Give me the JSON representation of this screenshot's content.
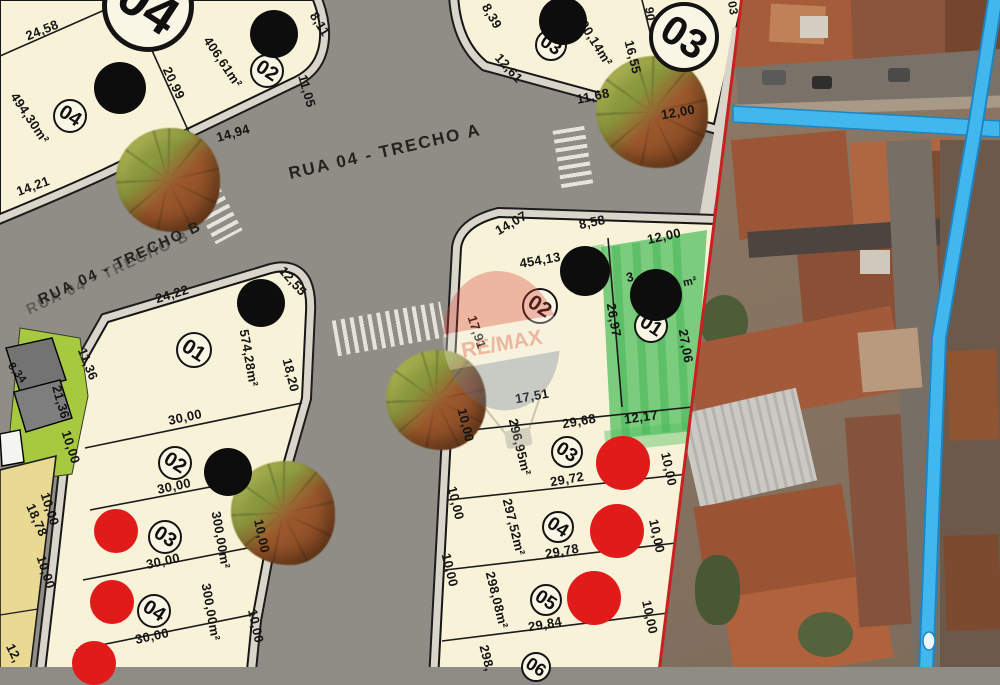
{
  "colors": {
    "lot_fill": "#f8f2d8",
    "street": "#8f8c86",
    "sidewalk": "#d9d5ca",
    "boundary_red": "#c92020",
    "highlight_green": "#57c163",
    "sold_dot_red": "#e11a1a",
    "privacy_dot_black": "#0d0d0d",
    "overlay_blue": "#42b7ee",
    "park_green": "#a6c93f",
    "neighbor_lot_yellow": "#e9d993"
  },
  "map": {
    "streets": [
      {
        "text": "RUA 04 - TRECHO A",
        "x": 385,
        "y": 152,
        "r": -13,
        "s": 17,
        "dbl": 0
      },
      {
        "text": "RUA 04 - TRECHO B",
        "x": 120,
        "y": 263,
        "r": -25,
        "s": 15,
        "dbl": 1
      }
    ],
    "quadra_badges": [
      {
        "label": "04",
        "cx": 148,
        "cy": 6,
        "r": 46,
        "bw": 5
      },
      {
        "label": "03",
        "cx": 684,
        "cy": 37,
        "r": 35,
        "bw": 4
      }
    ],
    "lot_badges": [
      {
        "label": "04",
        "cx": 70,
        "cy": 116,
        "r": 17
      },
      {
        "label": "02",
        "cx": 267,
        "cy": 71,
        "r": 17
      },
      {
        "label": "03",
        "cx": 551,
        "cy": 45,
        "r": 16
      },
      {
        "label": "02",
        "cx": 540,
        "cy": 306,
        "r": 18
      },
      {
        "label": "01",
        "cx": 651,
        "cy": 326,
        "r": 17
      },
      {
        "label": "01",
        "cx": 194,
        "cy": 350,
        "r": 18
      },
      {
        "label": "02",
        "cx": 175,
        "cy": 463,
        "r": 17
      },
      {
        "label": "03",
        "cx": 165,
        "cy": 537,
        "r": 17
      },
      {
        "label": "04",
        "cx": 154,
        "cy": 611,
        "r": 17
      },
      {
        "label": "03",
        "cx": 567,
        "cy": 452,
        "r": 16
      },
      {
        "label": "04",
        "cx": 558,
        "cy": 527,
        "r": 16
      },
      {
        "label": "05",
        "cx": 546,
        "cy": 600,
        "r": 16
      },
      {
        "label": "06",
        "cx": 536,
        "cy": 667,
        "r": 15
      }
    ],
    "measurements": [
      {
        "t": "24,58",
        "x": 42,
        "y": 30,
        "r": -22
      },
      {
        "t": "20,99",
        "x": 174,
        "y": 83,
        "r": 64
      },
      {
        "t": "14,94",
        "x": 233,
        "y": 133,
        "r": -16
      },
      {
        "t": "14,21",
        "x": 33,
        "y": 186,
        "r": -20
      },
      {
        "t": "494,30m²",
        "x": 30,
        "y": 118,
        "r": 56
      },
      {
        "t": "406,61m²",
        "x": 223,
        "y": 62,
        "r": 56
      },
      {
        "t": "8,11",
        "x": 320,
        "y": 24,
        "r": 58
      },
      {
        "t": "11,05",
        "x": 307,
        "y": 91,
        "r": 74
      },
      {
        "t": "8,39",
        "x": 492,
        "y": 16,
        "r": 60
      },
      {
        "t": "12,61",
        "x": 509,
        "y": 68,
        "r": 48
      },
      {
        "t": "300,14m²",
        "x": 594,
        "y": 40,
        "r": 58
      },
      {
        "t": "16,55",
        "x": 633,
        "y": 57,
        "r": 76
      },
      {
        "t": "11,68",
        "x": 593,
        "y": 96,
        "r": -12
      },
      {
        "t": "12,00",
        "x": 678,
        "y": 112,
        "r": -10
      },
      {
        "t": "90",
        "x": 650,
        "y": 14,
        "r": 82,
        "s": 12
      },
      {
        "t": "03",
        "x": 733,
        "y": 8,
        "r": 80,
        "s": 12
      },
      {
        "t": "14,07",
        "x": 511,
        "y": 223,
        "r": -30
      },
      {
        "t": "8,58",
        "x": 592,
        "y": 222,
        "r": -12
      },
      {
        "t": "454,13",
        "x": 540,
        "y": 260,
        "r": -10
      },
      {
        "t": "17,91",
        "x": 477,
        "y": 332,
        "r": 72
      },
      {
        "t": "26,97",
        "x": 614,
        "y": 320,
        "r": 80
      },
      {
        "t": "12,00",
        "x": 664,
        "y": 236,
        "r": -12
      },
      {
        "t": "3",
        "x": 630,
        "y": 277,
        "r": -12
      },
      {
        "t": "m²",
        "x": 690,
        "y": 282,
        "r": -12,
        "s": 11
      },
      {
        "t": "27,06",
        "x": 686,
        "y": 346,
        "r": 80
      },
      {
        "t": "12,17",
        "x": 641,
        "y": 417,
        "r": -8
      },
      {
        "t": "17,51",
        "x": 532,
        "y": 396,
        "r": -10
      },
      {
        "t": "29,68",
        "x": 579,
        "y": 421,
        "r": -10
      },
      {
        "t": "296,95m²",
        "x": 520,
        "y": 447,
        "r": 76
      },
      {
        "t": "29,72",
        "x": 567,
        "y": 479,
        "r": -10
      },
      {
        "t": "10,00",
        "x": 669,
        "y": 469,
        "r": 78
      },
      {
        "t": "10,00",
        "x": 456,
        "y": 503,
        "r": 76
      },
      {
        "t": "10,00",
        "x": 466,
        "y": 425,
        "r": 76
      },
      {
        "t": "297,52m²",
        "x": 514,
        "y": 527,
        "r": 76
      },
      {
        "t": "29,78",
        "x": 562,
        "y": 551,
        "r": -10
      },
      {
        "t": "10,00",
        "x": 657,
        "y": 536,
        "r": 78
      },
      {
        "t": "298,08m²",
        "x": 497,
        "y": 600,
        "r": 76
      },
      {
        "t": "29,84",
        "x": 545,
        "y": 624,
        "r": -10
      },
      {
        "t": "10,00",
        "x": 650,
        "y": 617,
        "r": 78
      },
      {
        "t": "10,00",
        "x": 450,
        "y": 570,
        "r": 76
      },
      {
        "t": "298,",
        "x": 487,
        "y": 658,
        "r": 76
      },
      {
        "t": "24,22",
        "x": 172,
        "y": 294,
        "r": -17
      },
      {
        "t": "12,55",
        "x": 293,
        "y": 281,
        "r": 48
      },
      {
        "t": "574,28m²",
        "x": 249,
        "y": 358,
        "r": 80
      },
      {
        "t": "18,20",
        "x": 291,
        "y": 375,
        "r": 76
      },
      {
        "t": "11,36",
        "x": 88,
        "y": 364,
        "r": 68
      },
      {
        "t": "21,36",
        "x": 61,
        "y": 402,
        "r": 74
      },
      {
        "t": "30,00",
        "x": 185,
        "y": 417,
        "r": -12
      },
      {
        "t": "10,00",
        "x": 71,
        "y": 447,
        "r": 72
      },
      {
        "t": "30,00",
        "x": 174,
        "y": 486,
        "r": -12
      },
      {
        "t": "10,00",
        "x": 50,
        "y": 509,
        "r": 72
      },
      {
        "t": "300,00m²",
        "x": 221,
        "y": 540,
        "r": 80
      },
      {
        "t": "30,00",
        "x": 163,
        "y": 561,
        "r": -12
      },
      {
        "t": "10,00",
        "x": 46,
        "y": 572,
        "r": 72
      },
      {
        "t": "300,00m²",
        "x": 211,
        "y": 612,
        "r": 80
      },
      {
        "t": "30,00",
        "x": 152,
        "y": 636,
        "r": -12
      },
      {
        "t": "10,00",
        "x": 262,
        "y": 536,
        "r": 78
      },
      {
        "t": "10,00",
        "x": 256,
        "y": 626,
        "r": 78
      },
      {
        "t": "18,78",
        "x": 37,
        "y": 520,
        "r": 66
      },
      {
        "t": "12,",
        "x": 14,
        "y": 653,
        "r": 64
      },
      {
        "t": "8,34",
        "x": 17,
        "y": 373,
        "r": 52,
        "s": 11
      }
    ],
    "dots": {
      "black": [
        [
          120,
          88,
          26
        ],
        [
          274,
          34,
          24
        ],
        [
          563,
          21,
          24
        ],
        [
          585,
          271,
          25
        ],
        [
          656,
          295,
          26
        ],
        [
          261,
          303,
          24
        ],
        [
          228,
          472,
          24
        ]
      ],
      "red": [
        [
          623,
          463,
          27
        ],
        [
          617,
          531,
          27
        ],
        [
          594,
          598,
          27
        ],
        [
          116,
          531,
          22
        ],
        [
          112,
          602,
          22
        ],
        [
          94,
          663,
          22
        ]
      ]
    },
    "trees": [
      [
        168,
        180,
        52
      ],
      [
        652,
        112,
        56
      ],
      [
        436,
        400,
        50
      ],
      [
        283,
        513,
        52
      ]
    ],
    "watermark": {
      "text": "RE/MAX"
    }
  }
}
